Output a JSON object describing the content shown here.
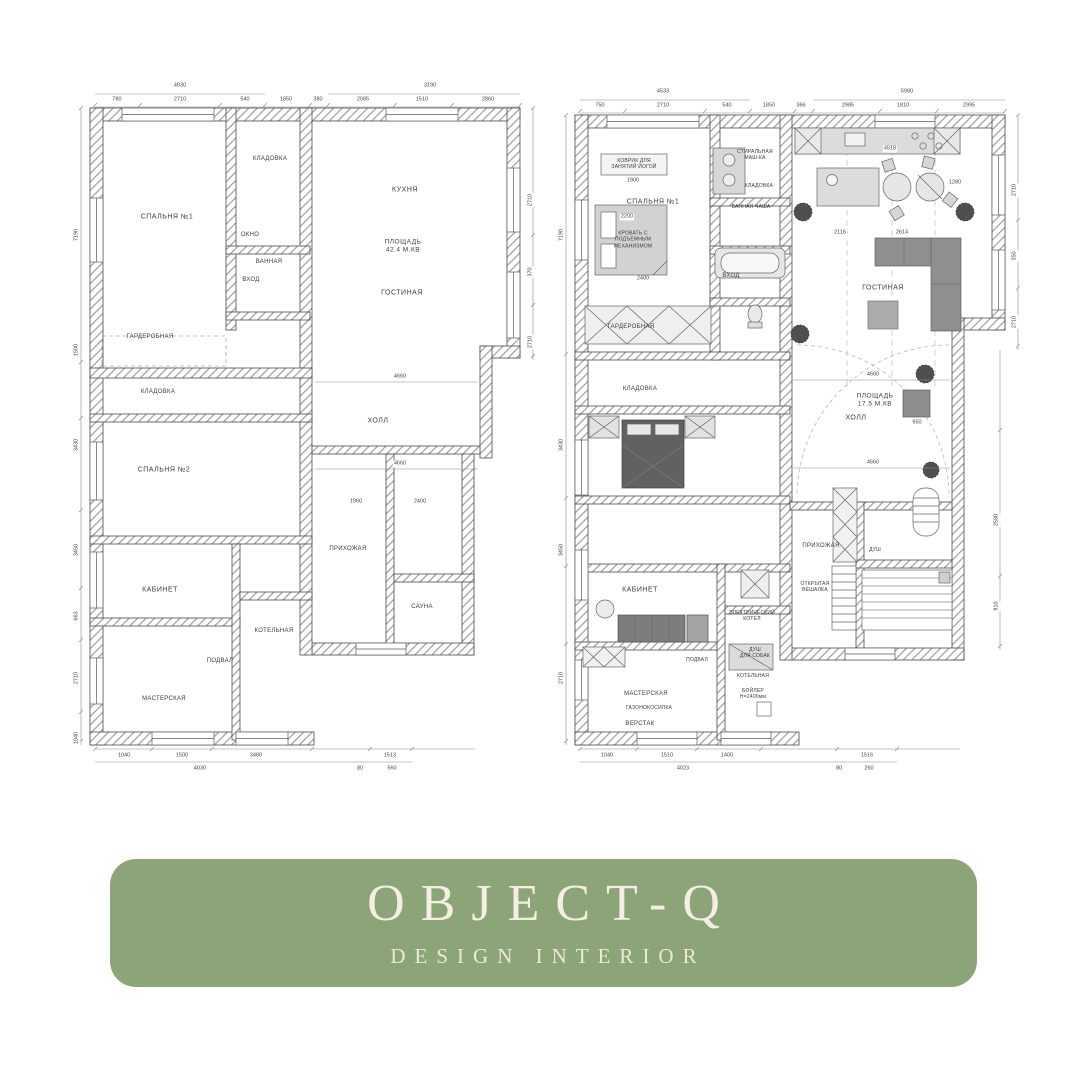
{
  "banner": {
    "title": "OBJECT-Q",
    "subtitle": "DESIGN INTERIOR",
    "bg": "#8BA478",
    "text_color": "#F3EFE2"
  },
  "plans": {
    "left": {
      "caption": "floor plan — dimensions",
      "labels": [
        {
          "t": "СПАЛЬНЯ №1",
          "x": 107,
          "y": 167,
          "c": "room"
        },
        {
          "t": "КЛАДОВКА",
          "x": 210,
          "y": 110,
          "c": "room sm"
        },
        {
          "t": "ОКНО",
          "x": 190,
          "y": 186,
          "c": "room sm"
        },
        {
          "t": "ВАННАЯ",
          "x": 209,
          "y": 213,
          "c": "room sm"
        },
        {
          "t": "ВХОД",
          "x": 191,
          "y": 231,
          "c": "room sm"
        },
        {
          "t": "КУХНЯ",
          "x": 345,
          "y": 140,
          "c": "room"
        },
        {
          "t": "ПЛОЩАДЬ\n42.4 М.КВ",
          "x": 343,
          "y": 197,
          "c": "room area"
        },
        {
          "t": "ГОСТИНАЯ",
          "x": 342,
          "y": 243,
          "c": "room"
        },
        {
          "t": "ГАРДЕРОБНАЯ",
          "x": 90,
          "y": 288,
          "c": "room sm"
        },
        {
          "t": "КЛАДОВКА",
          "x": 98,
          "y": 343,
          "c": "room sm"
        },
        {
          "t": "СПАЛЬНЯ №2",
          "x": 104,
          "y": 420,
          "c": "room"
        },
        {
          "t": "ХОЛЛ",
          "x": 318,
          "y": 371,
          "c": "room"
        },
        {
          "t": "ПРИХОЖАЯ",
          "x": 288,
          "y": 500,
          "c": "room sm"
        },
        {
          "t": "САУНА",
          "x": 362,
          "y": 558,
          "c": "room sm"
        },
        {
          "t": "КАБИНЕТ",
          "x": 100,
          "y": 540,
          "c": "room"
        },
        {
          "t": "ПОДВАЛ",
          "x": 160,
          "y": 612,
          "c": "room sm"
        },
        {
          "t": "МАСТЕРСКАЯ",
          "x": 104,
          "y": 650,
          "c": "room sm"
        },
        {
          "t": "КОТЕЛЬНАЯ",
          "x": 214,
          "y": 582,
          "c": "room sm"
        },
        {
          "t": "4030",
          "x": 120,
          "y": 36,
          "c": "dim"
        },
        {
          "t": "780",
          "x": 57,
          "y": 50,
          "c": "dim"
        },
        {
          "t": "2710",
          "x": 120,
          "y": 50,
          "c": "dim"
        },
        {
          "t": "540",
          "x": 185,
          "y": 50,
          "c": "dim"
        },
        {
          "t": "1850",
          "x": 226,
          "y": 50,
          "c": "dim"
        },
        {
          "t": "380",
          "x": 258,
          "y": 50,
          "c": "dim"
        },
        {
          "t": "3190",
          "x": 370,
          "y": 36,
          "c": "dim"
        },
        {
          "t": "2085",
          "x": 303,
          "y": 50,
          "c": "dim"
        },
        {
          "t": "1510",
          "x": 362,
          "y": 50,
          "c": "dim"
        },
        {
          "t": "2860",
          "x": 428,
          "y": 50,
          "c": "dim"
        },
        {
          "t": "1040",
          "x": 64,
          "y": 706,
          "c": "dim"
        },
        {
          "t": "1500",
          "x": 122,
          "y": 706,
          "c": "dim"
        },
        {
          "t": "3480",
          "x": 196,
          "y": 706,
          "c": "dim"
        },
        {
          "t": "1513",
          "x": 330,
          "y": 706,
          "c": "dim"
        },
        {
          "t": "4030",
          "x": 140,
          "y": 719,
          "c": "dim"
        },
        {
          "t": "80",
          "x": 300,
          "y": 719,
          "c": "dim"
        },
        {
          "t": "560",
          "x": 332,
          "y": 719,
          "c": "dim"
        },
        {
          "t": "7190",
          "x": 17,
          "y": 185,
          "c": "dim v",
          "r": -90
        },
        {
          "t": "1500",
          "x": 17,
          "y": 300,
          "c": "dim v",
          "r": -90
        },
        {
          "t": "3430",
          "x": 17,
          "y": 395,
          "c": "dim v",
          "r": -90
        },
        {
          "t": "3450",
          "x": 17,
          "y": 500,
          "c": "dim v",
          "r": -90
        },
        {
          "t": "663",
          "x": 17,
          "y": 566,
          "c": "dim v",
          "r": -90
        },
        {
          "t": "2710",
          "x": 17,
          "y": 628,
          "c": "dim v",
          "r": -90
        },
        {
          "t": "1040",
          "x": 17,
          "y": 688,
          "c": "dim v",
          "r": -90
        },
        {
          "t": "2710",
          "x": 471,
          "y": 150,
          "c": "dim v",
          "r": -90
        },
        {
          "t": "370",
          "x": 471,
          "y": 222,
          "c": "dim v",
          "r": -90
        },
        {
          "t": "2710",
          "x": 471,
          "y": 292,
          "c": "dim v",
          "r": -90
        },
        {
          "t": "4660",
          "x": 340,
          "y": 327,
          "c": "dim"
        },
        {
          "t": "4660",
          "x": 340,
          "y": 414,
          "c": "dim"
        },
        {
          "t": "1960",
          "x": 296,
          "y": 452,
          "c": "dim"
        },
        {
          "t": "2400",
          "x": 360,
          "y": 452,
          "c": "dim"
        }
      ]
    },
    "right": {
      "caption": "floor plan — furniture",
      "labels": [
        {
          "t": "СПАЛЬНЯ №1",
          "x": 108,
          "y": 152,
          "c": "room"
        },
        {
          "t": "КОВРИК ДЛЯ\nЗАНЯТИЙ ЙОГОЙ",
          "x": 89,
          "y": 114,
          "c": "room tiny"
        },
        {
          "t": "КРОВАТЬ С\nПОДЪЕМНЫМ\nМЕХАНИЗМОМ",
          "x": 88,
          "y": 190,
          "c": "room tiny"
        },
        {
          "t": "ГАРДЕРОБНАЯ",
          "x": 86,
          "y": 278,
          "c": "room sm"
        },
        {
          "t": "СТИРАЛЬНАЯ\nМАШ-КА",
          "x": 210,
          "y": 105,
          "c": "room tiny"
        },
        {
          "t": "КЛАДОВКА",
          "x": 214,
          "y": 136,
          "c": "room tiny"
        },
        {
          "t": "ВАННАЯ ЧАША",
          "x": 206,
          "y": 157,
          "c": "room tiny"
        },
        {
          "t": "ВХОД",
          "x": 186,
          "y": 227,
          "c": "room sm"
        },
        {
          "t": "ГОСТИНАЯ",
          "x": 338,
          "y": 238,
          "c": "room"
        },
        {
          "t": "КЛАДОВКА",
          "x": 95,
          "y": 340,
          "c": "room sm"
        },
        {
          "t": "ПЛОЩАДЬ\n17.5 М.КВ",
          "x": 330,
          "y": 351,
          "c": "room area"
        },
        {
          "t": "ХОЛЛ",
          "x": 311,
          "y": 368,
          "c": "room"
        },
        {
          "t": "ПРИХОЖАЯ",
          "x": 276,
          "y": 497,
          "c": "room sm"
        },
        {
          "t": "ОТКРЫТАЯ\nВЕШАЛКА",
          "x": 270,
          "y": 537,
          "c": "room tiny"
        },
        {
          "t": "ДУШ",
          "x": 330,
          "y": 500,
          "c": "room tiny"
        },
        {
          "t": "КАБИНЕТ",
          "x": 95,
          "y": 540,
          "c": "room"
        },
        {
          "t": "ПОДВАЛ",
          "x": 152,
          "y": 610,
          "c": "room tiny"
        },
        {
          "t": "МАСТЕРСКАЯ",
          "x": 101,
          "y": 645,
          "c": "room sm"
        },
        {
          "t": "ГАЗОНОКОСИЛКА",
          "x": 104,
          "y": 658,
          "c": "room tiny"
        },
        {
          "t": "ВЕРСТАК",
          "x": 95,
          "y": 675,
          "c": "room sm"
        },
        {
          "t": "ЭЛЕКТРИЧЕСКИЙ\nКОТЕЛ",
          "x": 207,
          "y": 566,
          "c": "room tiny"
        },
        {
          "t": "ДУШ\nДЛЯ СОБАК",
          "x": 210,
          "y": 603,
          "c": "room tiny"
        },
        {
          "t": "КОТЕЛЬНАЯ",
          "x": 208,
          "y": 626,
          "c": "room tiny"
        },
        {
          "t": "БОЙЛЕР\nН=2400мм",
          "x": 208,
          "y": 644,
          "c": "room tiny"
        },
        {
          "t": "4533",
          "x": 118,
          "y": 42,
          "c": "dim"
        },
        {
          "t": "750",
          "x": 55,
          "y": 56,
          "c": "dim"
        },
        {
          "t": "2710",
          "x": 118,
          "y": 56,
          "c": "dim"
        },
        {
          "t": "540",
          "x": 182,
          "y": 56,
          "c": "dim"
        },
        {
          "t": "1850",
          "x": 224,
          "y": 56,
          "c": "dim"
        },
        {
          "t": "366",
          "x": 256,
          "y": 56,
          "c": "dim"
        },
        {
          "t": "5980",
          "x": 362,
          "y": 42,
          "c": "dim"
        },
        {
          "t": "2985",
          "x": 303,
          "y": 56,
          "c": "dim"
        },
        {
          "t": "1810",
          "x": 358,
          "y": 56,
          "c": "dim"
        },
        {
          "t": "2995",
          "x": 424,
          "y": 56,
          "c": "dim"
        },
        {
          "t": "1040",
          "x": 62,
          "y": 706,
          "c": "dim"
        },
        {
          "t": "1510",
          "x": 122,
          "y": 706,
          "c": "dim"
        },
        {
          "t": "1400",
          "x": 182,
          "y": 706,
          "c": "dim"
        },
        {
          "t": "1516",
          "x": 322,
          "y": 706,
          "c": "dim"
        },
        {
          "t": "4023",
          "x": 138,
          "y": 719,
          "c": "dim"
        },
        {
          "t": "80",
          "x": 294,
          "y": 719,
          "c": "dim"
        },
        {
          "t": "260",
          "x": 324,
          "y": 719,
          "c": "dim"
        },
        {
          "t": "7190",
          "x": 17,
          "y": 185,
          "c": "dim v",
          "r": -90
        },
        {
          "t": "3430",
          "x": 17,
          "y": 395,
          "c": "dim v",
          "r": -90
        },
        {
          "t": "3450",
          "x": 17,
          "y": 500,
          "c": "dim v",
          "r": -90
        },
        {
          "t": "2710",
          "x": 17,
          "y": 628,
          "c": "dim v",
          "r": -90
        },
        {
          "t": "2710",
          "x": 470,
          "y": 140,
          "c": "dim v",
          "r": -90
        },
        {
          "t": "350",
          "x": 470,
          "y": 206,
          "c": "dim v",
          "r": -90
        },
        {
          "t": "2710",
          "x": 470,
          "y": 272,
          "c": "dim v",
          "r": -90
        },
        {
          "t": "2580",
          "x": 452,
          "y": 470,
          "c": "dim v",
          "r": -90
        },
        {
          "t": "910",
          "x": 452,
          "y": 556,
          "c": "dim v",
          "r": -90
        },
        {
          "t": "1900",
          "x": 88,
          "y": 131,
          "c": "dim"
        },
        {
          "t": "2200",
          "x": 82,
          "y": 167,
          "c": "dim"
        },
        {
          "t": "2400",
          "x": 98,
          "y": 229,
          "c": "dim"
        },
        {
          "t": "4518",
          "x": 345,
          "y": 99,
          "c": "dim"
        },
        {
          "t": "1280",
          "x": 410,
          "y": 133,
          "c": "dim"
        },
        {
          "t": "2116",
          "x": 295,
          "y": 183,
          "c": "dim"
        },
        {
          "t": "2614",
          "x": 357,
          "y": 183,
          "c": "dim"
        },
        {
          "t": "4660",
          "x": 328,
          "y": 325,
          "c": "dim"
        },
        {
          "t": "4660",
          "x": 328,
          "y": 413,
          "c": "dim"
        },
        {
          "t": "950",
          "x": 372,
          "y": 373,
          "c": "dim"
        }
      ]
    }
  }
}
